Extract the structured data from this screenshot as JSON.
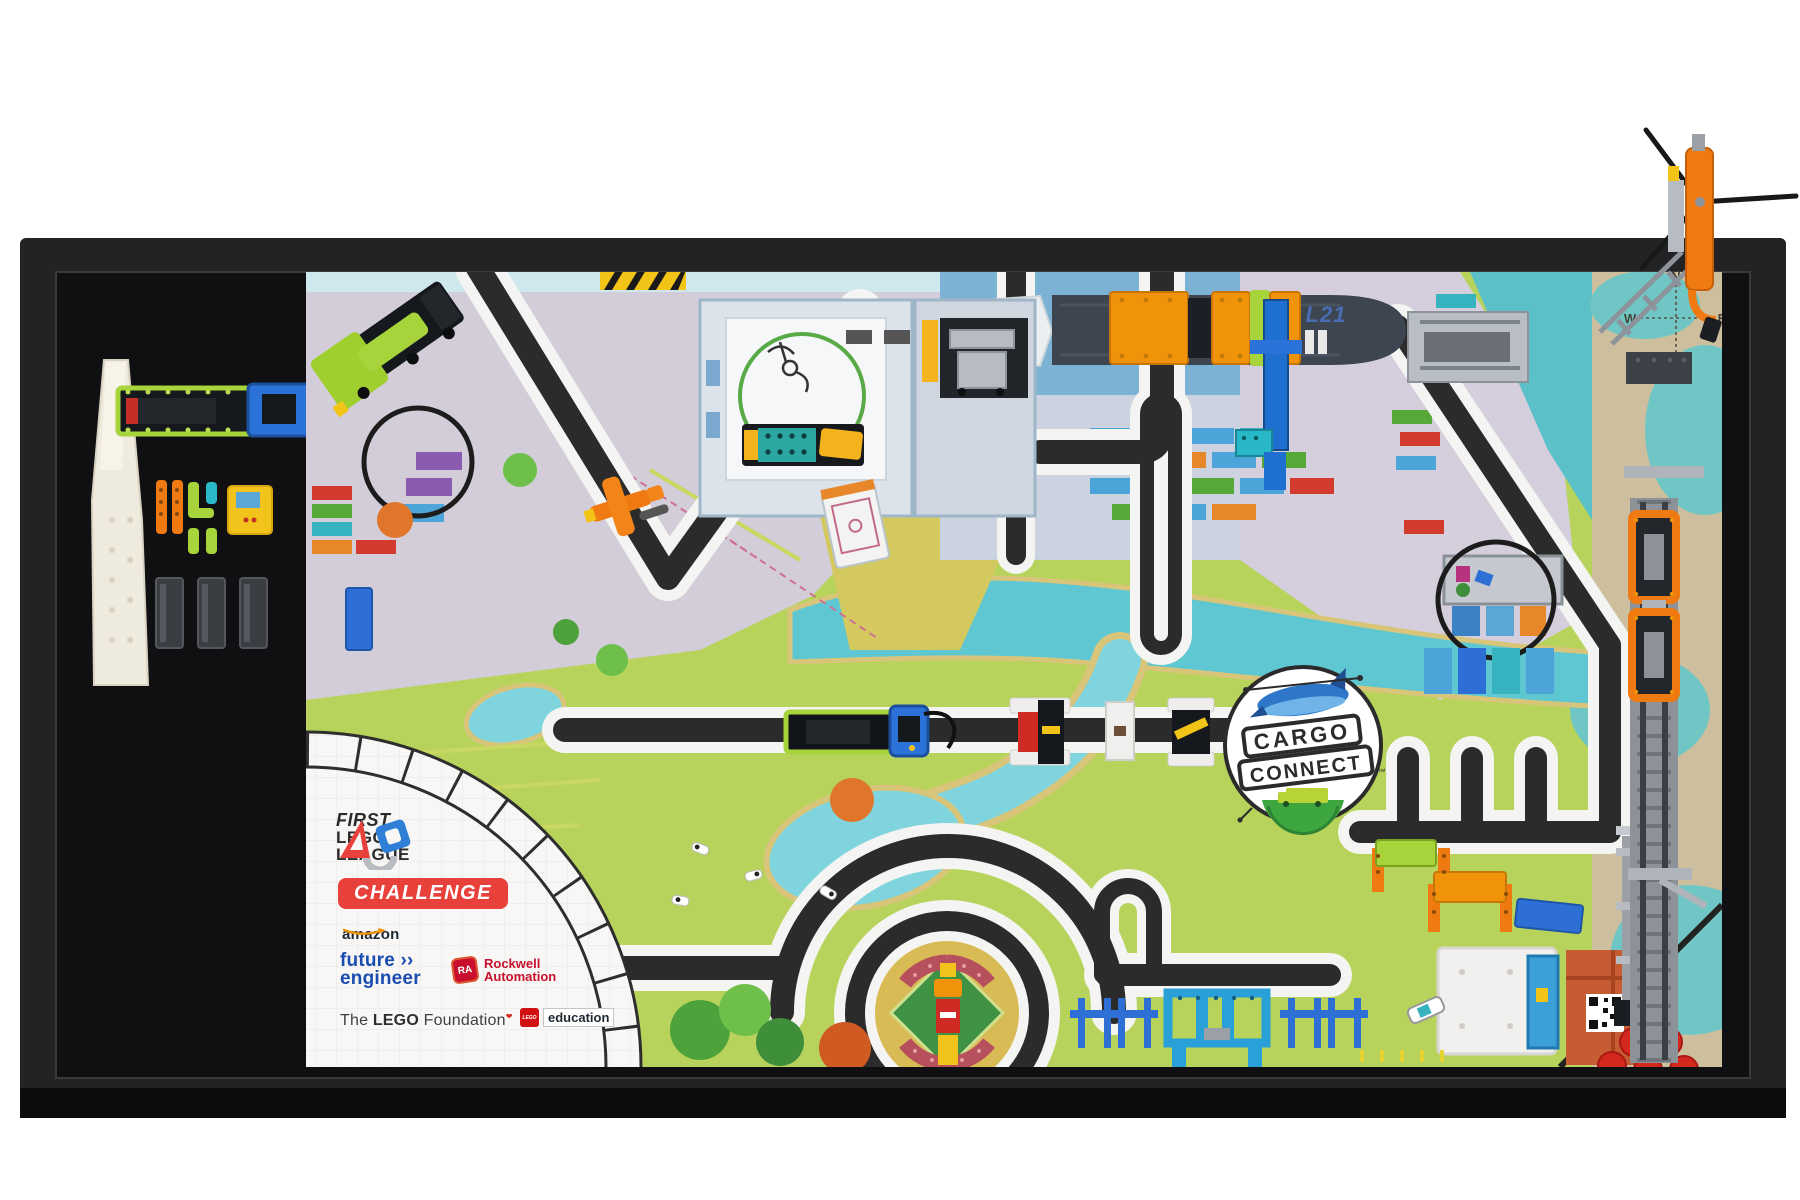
{
  "branding": {
    "fll": {
      "first": "FIRST",
      "lego": "LEGO",
      "league": "LEAGUE",
      "program": "CHALLENGE"
    },
    "cargo_connect": {
      "line1": "CARGO",
      "line2": "CONNECT",
      "tm": "™"
    }
  },
  "sponsors": {
    "amazon": {
      "wordmark": "amazon",
      "line1": "future",
      "arrows": "››",
      "line2": "engineer"
    },
    "rockwell": {
      "badge": "RA",
      "line1": "Rockwell",
      "line2": "Automation"
    },
    "lego_foundation": {
      "pre": "The ",
      "brand": "LEGO",
      "post": " Foundation"
    },
    "lego_education": {
      "brand": "LEGO",
      "word": "education"
    }
  },
  "mat": {
    "ship_registry": "L21",
    "compass": {
      "n": "N",
      "e": "E",
      "s": "S",
      "w": "W"
    }
  },
  "colors": {
    "frame": "#1d1d1f",
    "mat_green": "#b7d35b",
    "water_teal": "#5ec7d2",
    "harbor_blue": "#7cb3d4",
    "road_black": "#2b2b2b",
    "road_white": "#f4f4f2",
    "challenge_red": "#e8413c",
    "rockwell_red": "#c8102e",
    "future_engineer_blue": "#1b4db1",
    "cargo_logo_green": "#3da63f",
    "container_orange": "#f0930a",
    "lego_lime": "#a6d43a",
    "helicopter_orange": "#f07a12",
    "parchment": "#cdbf9d"
  }
}
